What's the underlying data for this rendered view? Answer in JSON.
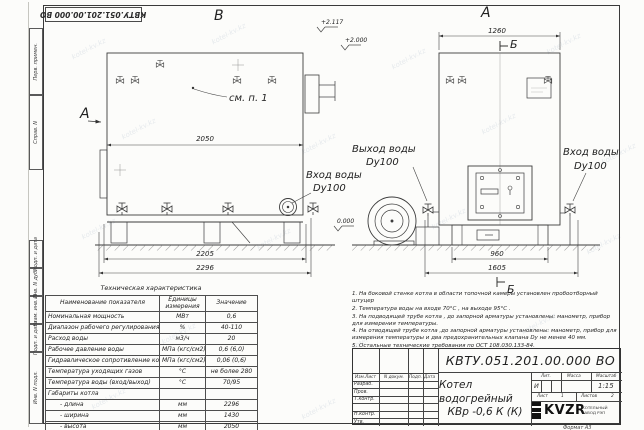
{
  "watermark": {
    "text": "kotel-kv.kz"
  },
  "sheet": {
    "stamp_top": "КВТУ.051.201.00.000 ВО",
    "format_note": "Формат  А3",
    "margin_boxes": [
      "Перв. примен.",
      "Справ. N",
      "Подп. и дата",
      "Инв. N дубл.",
      "Взам. инв. N",
      "Подп. и дата",
      "Инв. N подл."
    ]
  },
  "views": {
    "view_b": "В",
    "view_a": "А",
    "arrow_a": "А",
    "section_b_top": "Б",
    "section_b_bottom": "Б",
    "callout": "см. п. 1",
    "elev_flue": "+2.117",
    "elev_pipe": "+2.000",
    "elev_ground": "0.000",
    "outlet_line1": "Выход воды",
    "outlet_line2": "Dy100",
    "inlet_side_line1": "Вход воды",
    "inlet_side_line2": "Dy100",
    "inlet_front_line1": "Вход воды",
    "inlet_front_line2": "Dy100",
    "dims": {
      "b_width": "2050",
      "b_base": "2205",
      "b_overall": "2296",
      "a_width": "1260",
      "a_base": "960",
      "a_overall": "1605"
    }
  },
  "tech_table": {
    "title": "Техническая характеристика",
    "headers": [
      "Наименование показателя",
      "Единицы измерения",
      "Значение"
    ],
    "rows": [
      [
        "Номинальная мощность",
        "МВт",
        "0,6"
      ],
      [
        "Диапазон рабочего регулирования",
        "%",
        "40-110"
      ],
      [
        "Расход воды",
        "м3/ч",
        "20"
      ],
      [
        "Рабочее давление воды",
        "МПа (кгс/см2)",
        "0,6 (6,0)"
      ],
      [
        "Гидравлическое сопротивление котла",
        "МПа (кгс/см2)",
        "0,06 (0,6)"
      ],
      [
        "Температура уходящих газов",
        "°С",
        "не более 280"
      ],
      [
        "Температура воды (вход/выход)",
        "°С",
        "70/95"
      ],
      [
        "Габариты котла",
        "",
        ""
      ],
      [
        "- длина",
        "мм",
        "2296"
      ],
      [
        "- ширина",
        "мм",
        "1430"
      ],
      [
        "- высота",
        "мм",
        "2050"
      ]
    ]
  },
  "notes": {
    "items": [
      "1.  На боковой стенке котла в области топочной камеры установлен пробоотборный штуцер",
      "2.  Температура воды на входе  70°С , на выходе  95°С .",
      "3.  На подводящей трубе котла , до запорной арматуры установлены:  манометр,  прибор для измерения температуры.",
      "4.  На отводящей трубе котла ,до запорной арматуры установлены:  манометр,  прибор для измерения температуры и два предохранительных клапана  Dy не менее  40 мм.",
      "5.  Остальные технические требования по ОСТ  108.030.133-84."
    ]
  },
  "title_block": {
    "doc_number": "КВТУ.051.201.00.000  ВО",
    "name_line1": "Котел водогрейный",
    "name_line2": "КВр -0,6  К  (К)",
    "header_cells": [
      "Изм.Лист",
      "N докум.",
      "Подп.",
      "Дата"
    ],
    "row_labels": [
      "Разраб.",
      "Пров.",
      "Т.контр.",
      "Н.контр.",
      "Утв."
    ],
    "lit_label": "Лит.",
    "lit_value": "И",
    "mass_label": "Масса",
    "scale_label": "Масштаб",
    "scale_value": "1:15",
    "sheet_label": "Лист",
    "sheet_value": "1",
    "sheets_label": "Листов",
    "sheets_value": "2",
    "company": "KVZR",
    "company_sub1": "КОТЕЛЬНЫЙ",
    "company_sub2": "ЗАВОД РЭП"
  }
}
